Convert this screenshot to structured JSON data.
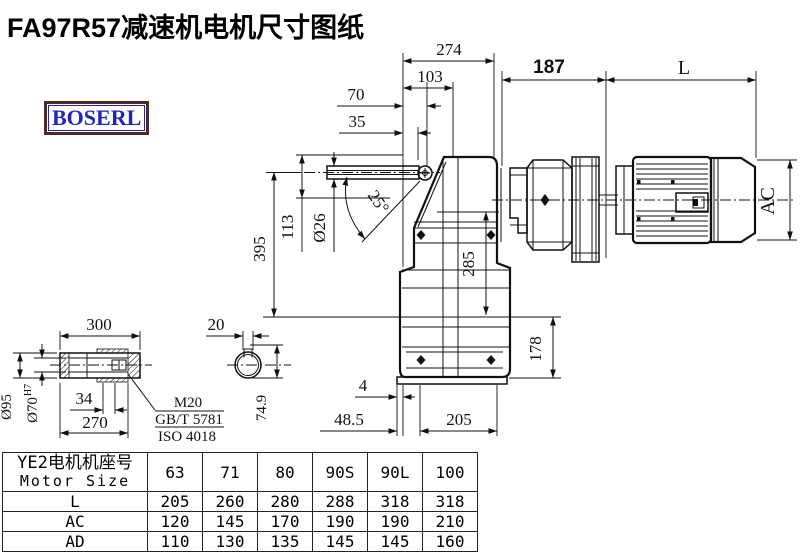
{
  "title": "FA97R57减速机电机尺寸图纸",
  "logo": {
    "text": "BOSERL"
  },
  "colors": {
    "line": "#111111",
    "title": "#000000",
    "logo_text": "#2224bb",
    "logo_border": "#4b2d26",
    "background": "#ffffff"
  },
  "dims": {
    "d274": "274",
    "d103": "103",
    "d70": "70",
    "d35": "35",
    "d187": "187",
    "dL": "L",
    "d395": "395",
    "d113": "113",
    "d26": "Ø26",
    "angle": "25°",
    "d285": "285",
    "d178": "178",
    "dAC": "AC",
    "d4": "4",
    "d48_5": "48.5",
    "d205": "205",
    "s300": "300",
    "s270": "270",
    "s34": "34",
    "s95": "Ø95",
    "s70": "Ø70",
    "s70sup": "H7",
    "s20": "20",
    "s74_9": "74.9",
    "note_m20": "M20",
    "note_gbt": "GB/T 5781",
    "note_iso": "ISO 4018"
  },
  "table": {
    "header_cn": "YE2电机机座号",
    "header_en": "Motor Size",
    "col_headers": [
      "63",
      "71",
      "80",
      "90S",
      "90L",
      "100"
    ],
    "rows": [
      {
        "label": "L",
        "values": [
          "205",
          "260",
          "280",
          "288",
          "318",
          "318"
        ]
      },
      {
        "label": "AC",
        "values": [
          "120",
          "145",
          "170",
          "190",
          "190",
          "210"
        ]
      },
      {
        "label": "AD",
        "values": [
          "110",
          "130",
          "135",
          "145",
          "145",
          "160"
        ]
      }
    ]
  }
}
